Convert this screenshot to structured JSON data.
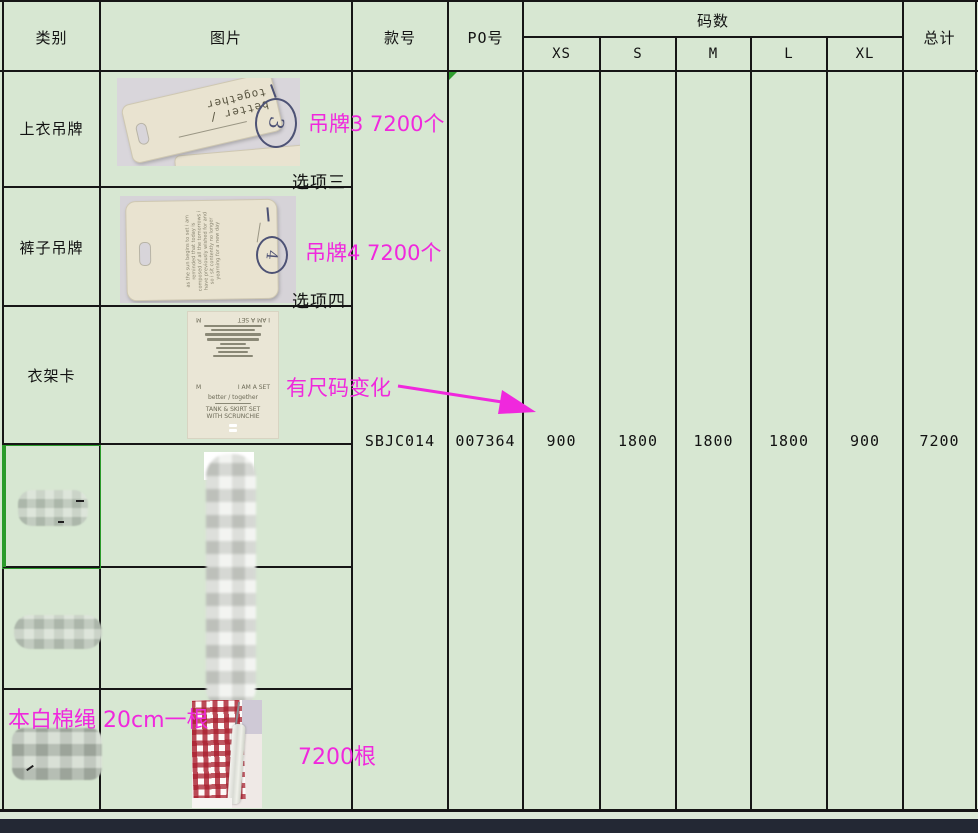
{
  "colors": {
    "cell_green": "#d7e7d2",
    "grid_line": "#161616",
    "annotation_pink": "#f028dd",
    "selection_green": "#2b9b2b",
    "bottom_bar": "#232834",
    "photo_backdrop": "#d9d6db",
    "tag_beige": "#e9e3d0"
  },
  "header": {
    "category": "类别",
    "image": "图片",
    "style_no": "款号",
    "po_no": "PO号",
    "sizes_group": "码数",
    "sizes": [
      "XS",
      "S",
      "M",
      "L",
      "XL"
    ],
    "total": "总计"
  },
  "order": {
    "style_no": "SBJC014",
    "po_no": "007364",
    "qty_xs": "900",
    "qty_s": "1800",
    "qty_m": "1800",
    "qty_l": "1800",
    "qty_xl": "900",
    "qty_total": "7200"
  },
  "rows": {
    "top_tag": {
      "category": "上衣吊牌",
      "annotation": "吊牌3 7200个",
      "option": "选项三"
    },
    "pants_tag": {
      "category": "裤子吊牌",
      "annotation": "吊牌4 7200个",
      "option": "选项四"
    },
    "hanger_card": {
      "category": "衣架卡",
      "annotation": "有尺码变化"
    },
    "cotton_rope": {
      "annotation_label": "本白棉绳 20cm一根",
      "annotation_qty": "7200根"
    }
  },
  "photos": {
    "top_tag": {
      "tag_text": "better / together",
      "handwritten_mark": "3"
    },
    "pants_tag": {
      "handwritten_mark": "4",
      "paragraph": "as the sun begins to set i am reminded that today is composed of all the tomorrows i have previously wished for and so i sit contently no longer yearning for a new day"
    },
    "hanger_card": {
      "size_letter": "M",
      "set_label": "I AM A SET",
      "brand_line": "better / together",
      "product_line1": "TANK & SKIRT SET",
      "product_line2": "WITH SCRUNCHIE"
    }
  }
}
